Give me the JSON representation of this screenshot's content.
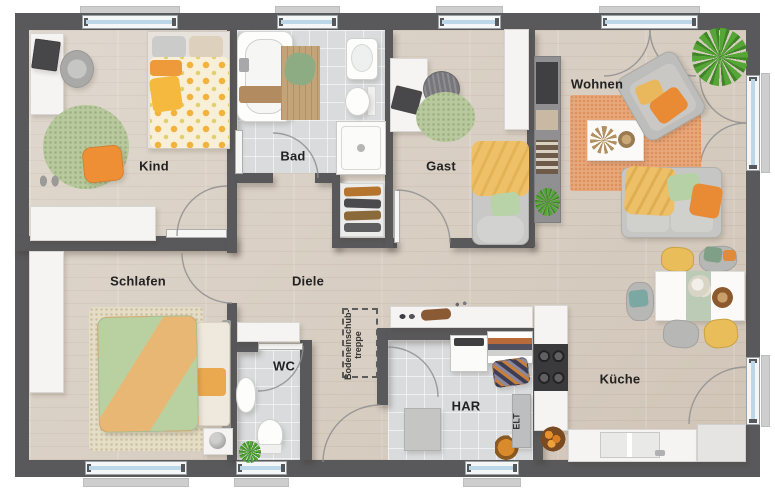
{
  "rooms": {
    "kind": "Kind",
    "bad": "Bad",
    "gast": "Gast",
    "wohnen": "Wohnen",
    "schlafen": "Schlafen",
    "diele": "Diele",
    "wc": "WC",
    "har": "HAR",
    "kueche": "Küche",
    "elt": "ELT",
    "attic_line1": "Bodeneinschub-",
    "attic_line2": "treppe"
  },
  "colors": {
    "wall": "#59595b",
    "wood": "#d8cec2",
    "tile": "#d9dbdd",
    "accent-orange": "#e98a35",
    "accent-yellow": "#eec069",
    "accent-green": "#b5d0a5",
    "window-glass": "#bcd8e8"
  }
}
